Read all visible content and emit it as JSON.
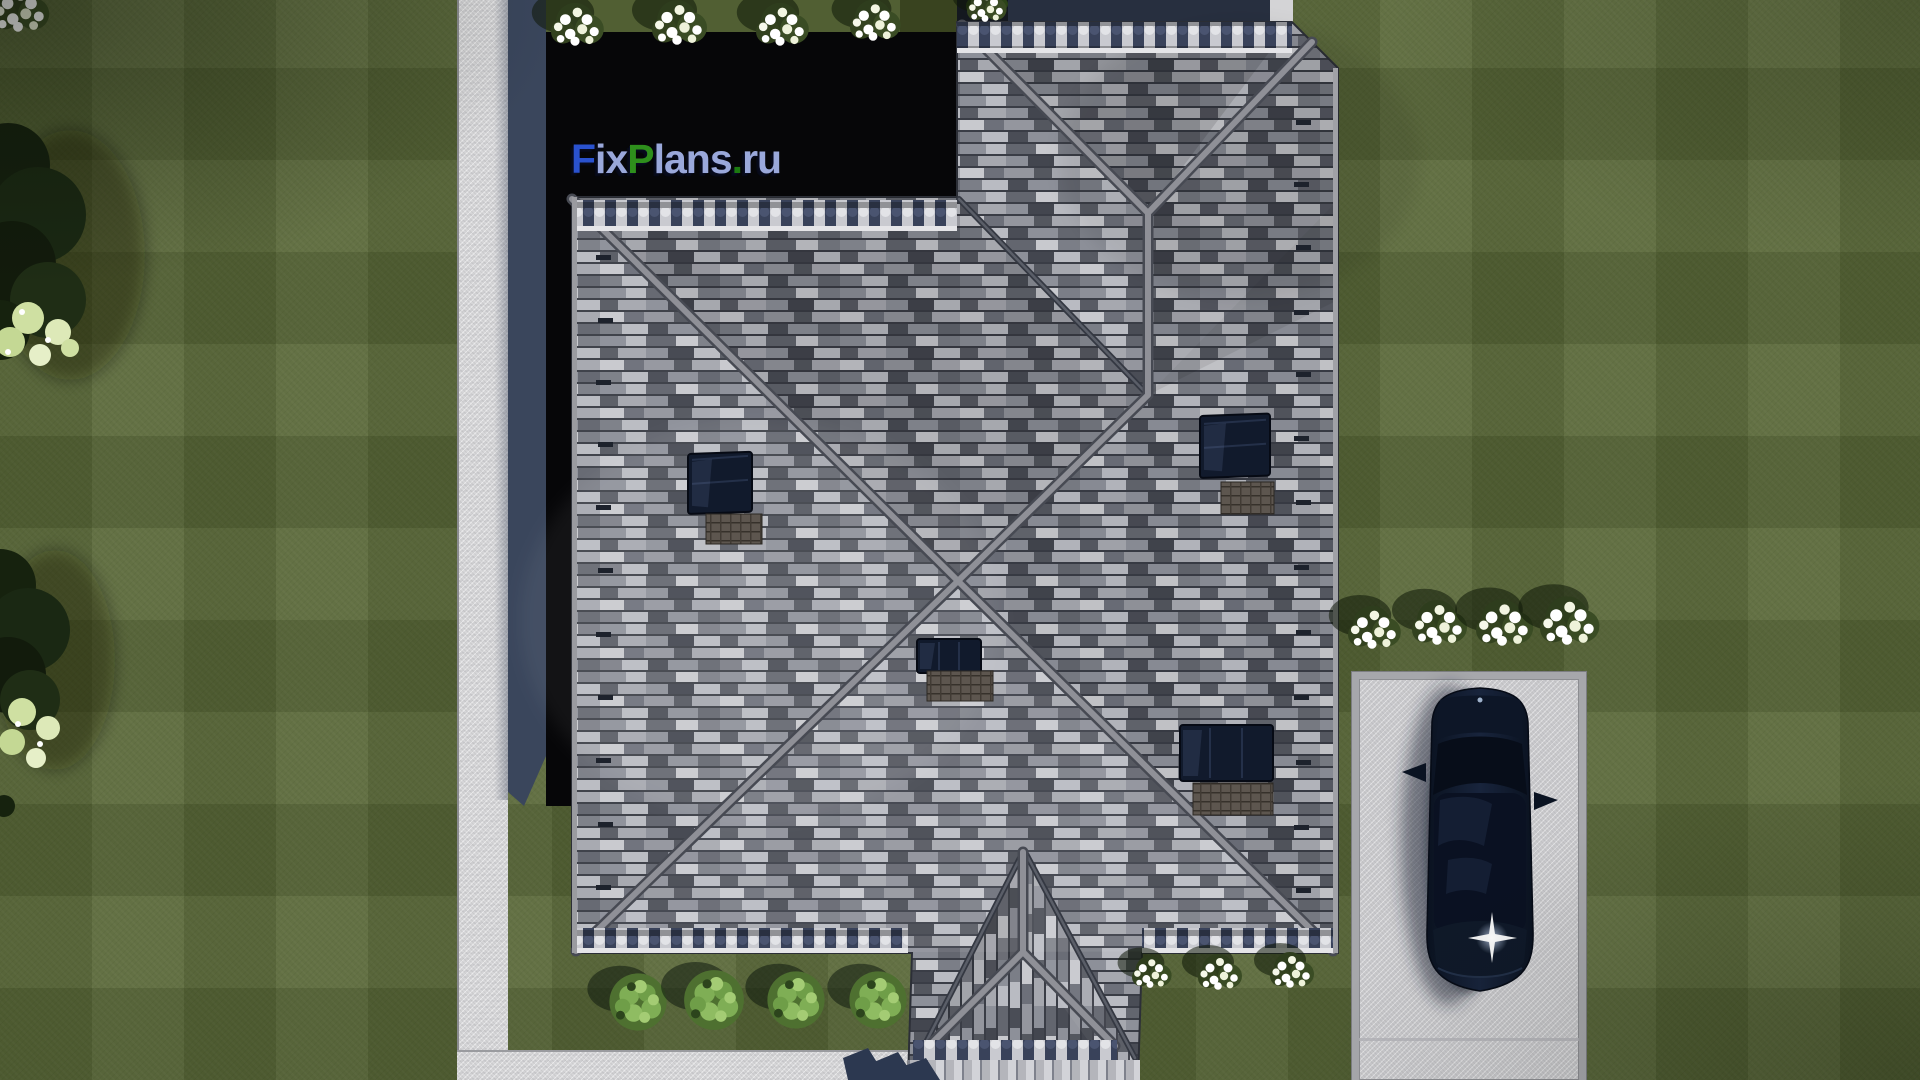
{
  "title": "Aerial top-down render of a hip-roof house plan (FixPlans.ru visualization)",
  "watermark": {
    "text": "FixPlans.ru",
    "segments": [
      {
        "text": "F",
        "color": "#2a52cf"
      },
      {
        "text": "ix",
        "color": "#9aa8da"
      },
      {
        "text": "P",
        "color": "#2e8f1c"
      },
      {
        "text": "lans",
        "color": "#9aa8da"
      },
      {
        "text": ".",
        "color": "#1c7a10"
      },
      {
        "text": "ru",
        "color": "#9aa8da"
      }
    ]
  },
  "palette": {
    "lawn": "#5b693a",
    "lawn_stripe": "#4d5c30",
    "walkway": "#d6d6d8",
    "driveway": "#c9c9cc",
    "curb": "#a6a7ab",
    "roof_base": "#767983",
    "roof_ridge": "#8f9097",
    "roof_edge_dark": "#474a53",
    "eave_caps_navy": "#333b4e",
    "wall_navy": "#3a465c",
    "black_region": "#060608",
    "skylight_glass": "#111a2c",
    "roof_panel_brown": "#57504a",
    "car_body": "#0c1524",
    "flower_white": "#ffffff",
    "bush_green": "#7fae55",
    "tree_dark": "#1a2813"
  },
  "scene": {
    "house": "L-shaped gray tile hip roof seen from directly above",
    "skylights": 4,
    "roof_panels": 4,
    "car": "black sedan parked on concrete driveway, headlight lens flare",
    "flower_clusters_top": 5,
    "flower_clusters_right": 4,
    "flower_clusters_bottom": 3,
    "green_bushes_bottom": 4,
    "trees_left_edge": 2
  }
}
